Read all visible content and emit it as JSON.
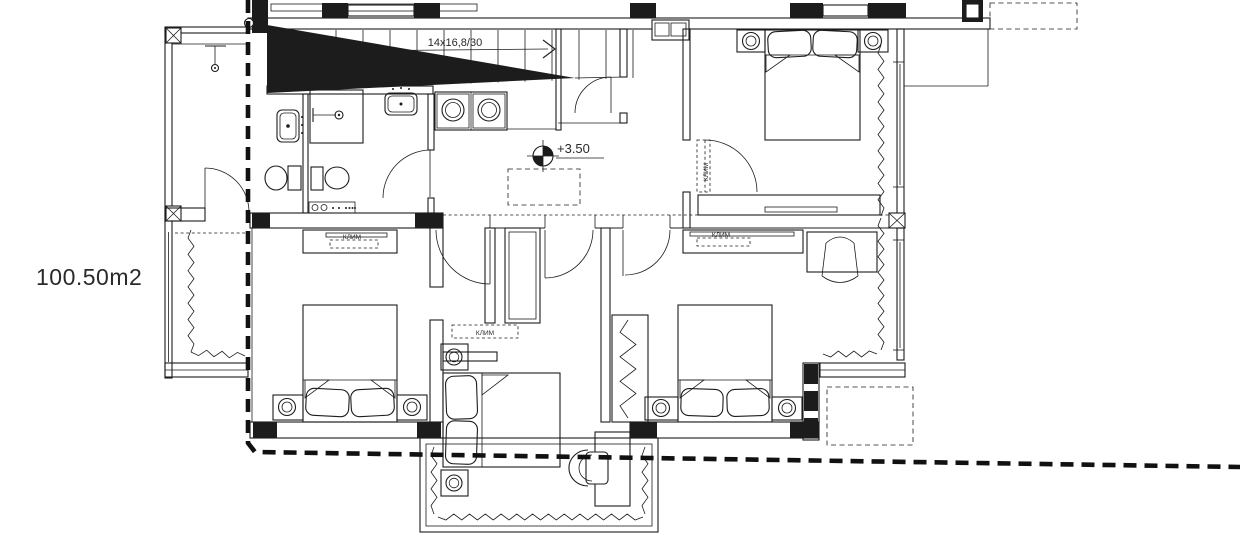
{
  "canvas": {
    "background": "#ffffff",
    "ink": "#1c1c1c"
  },
  "labels": {
    "area": "100.50m2",
    "stairs": "14x16,8/30",
    "level": "+3.50",
    "ac": "КЛИМ"
  }
}
